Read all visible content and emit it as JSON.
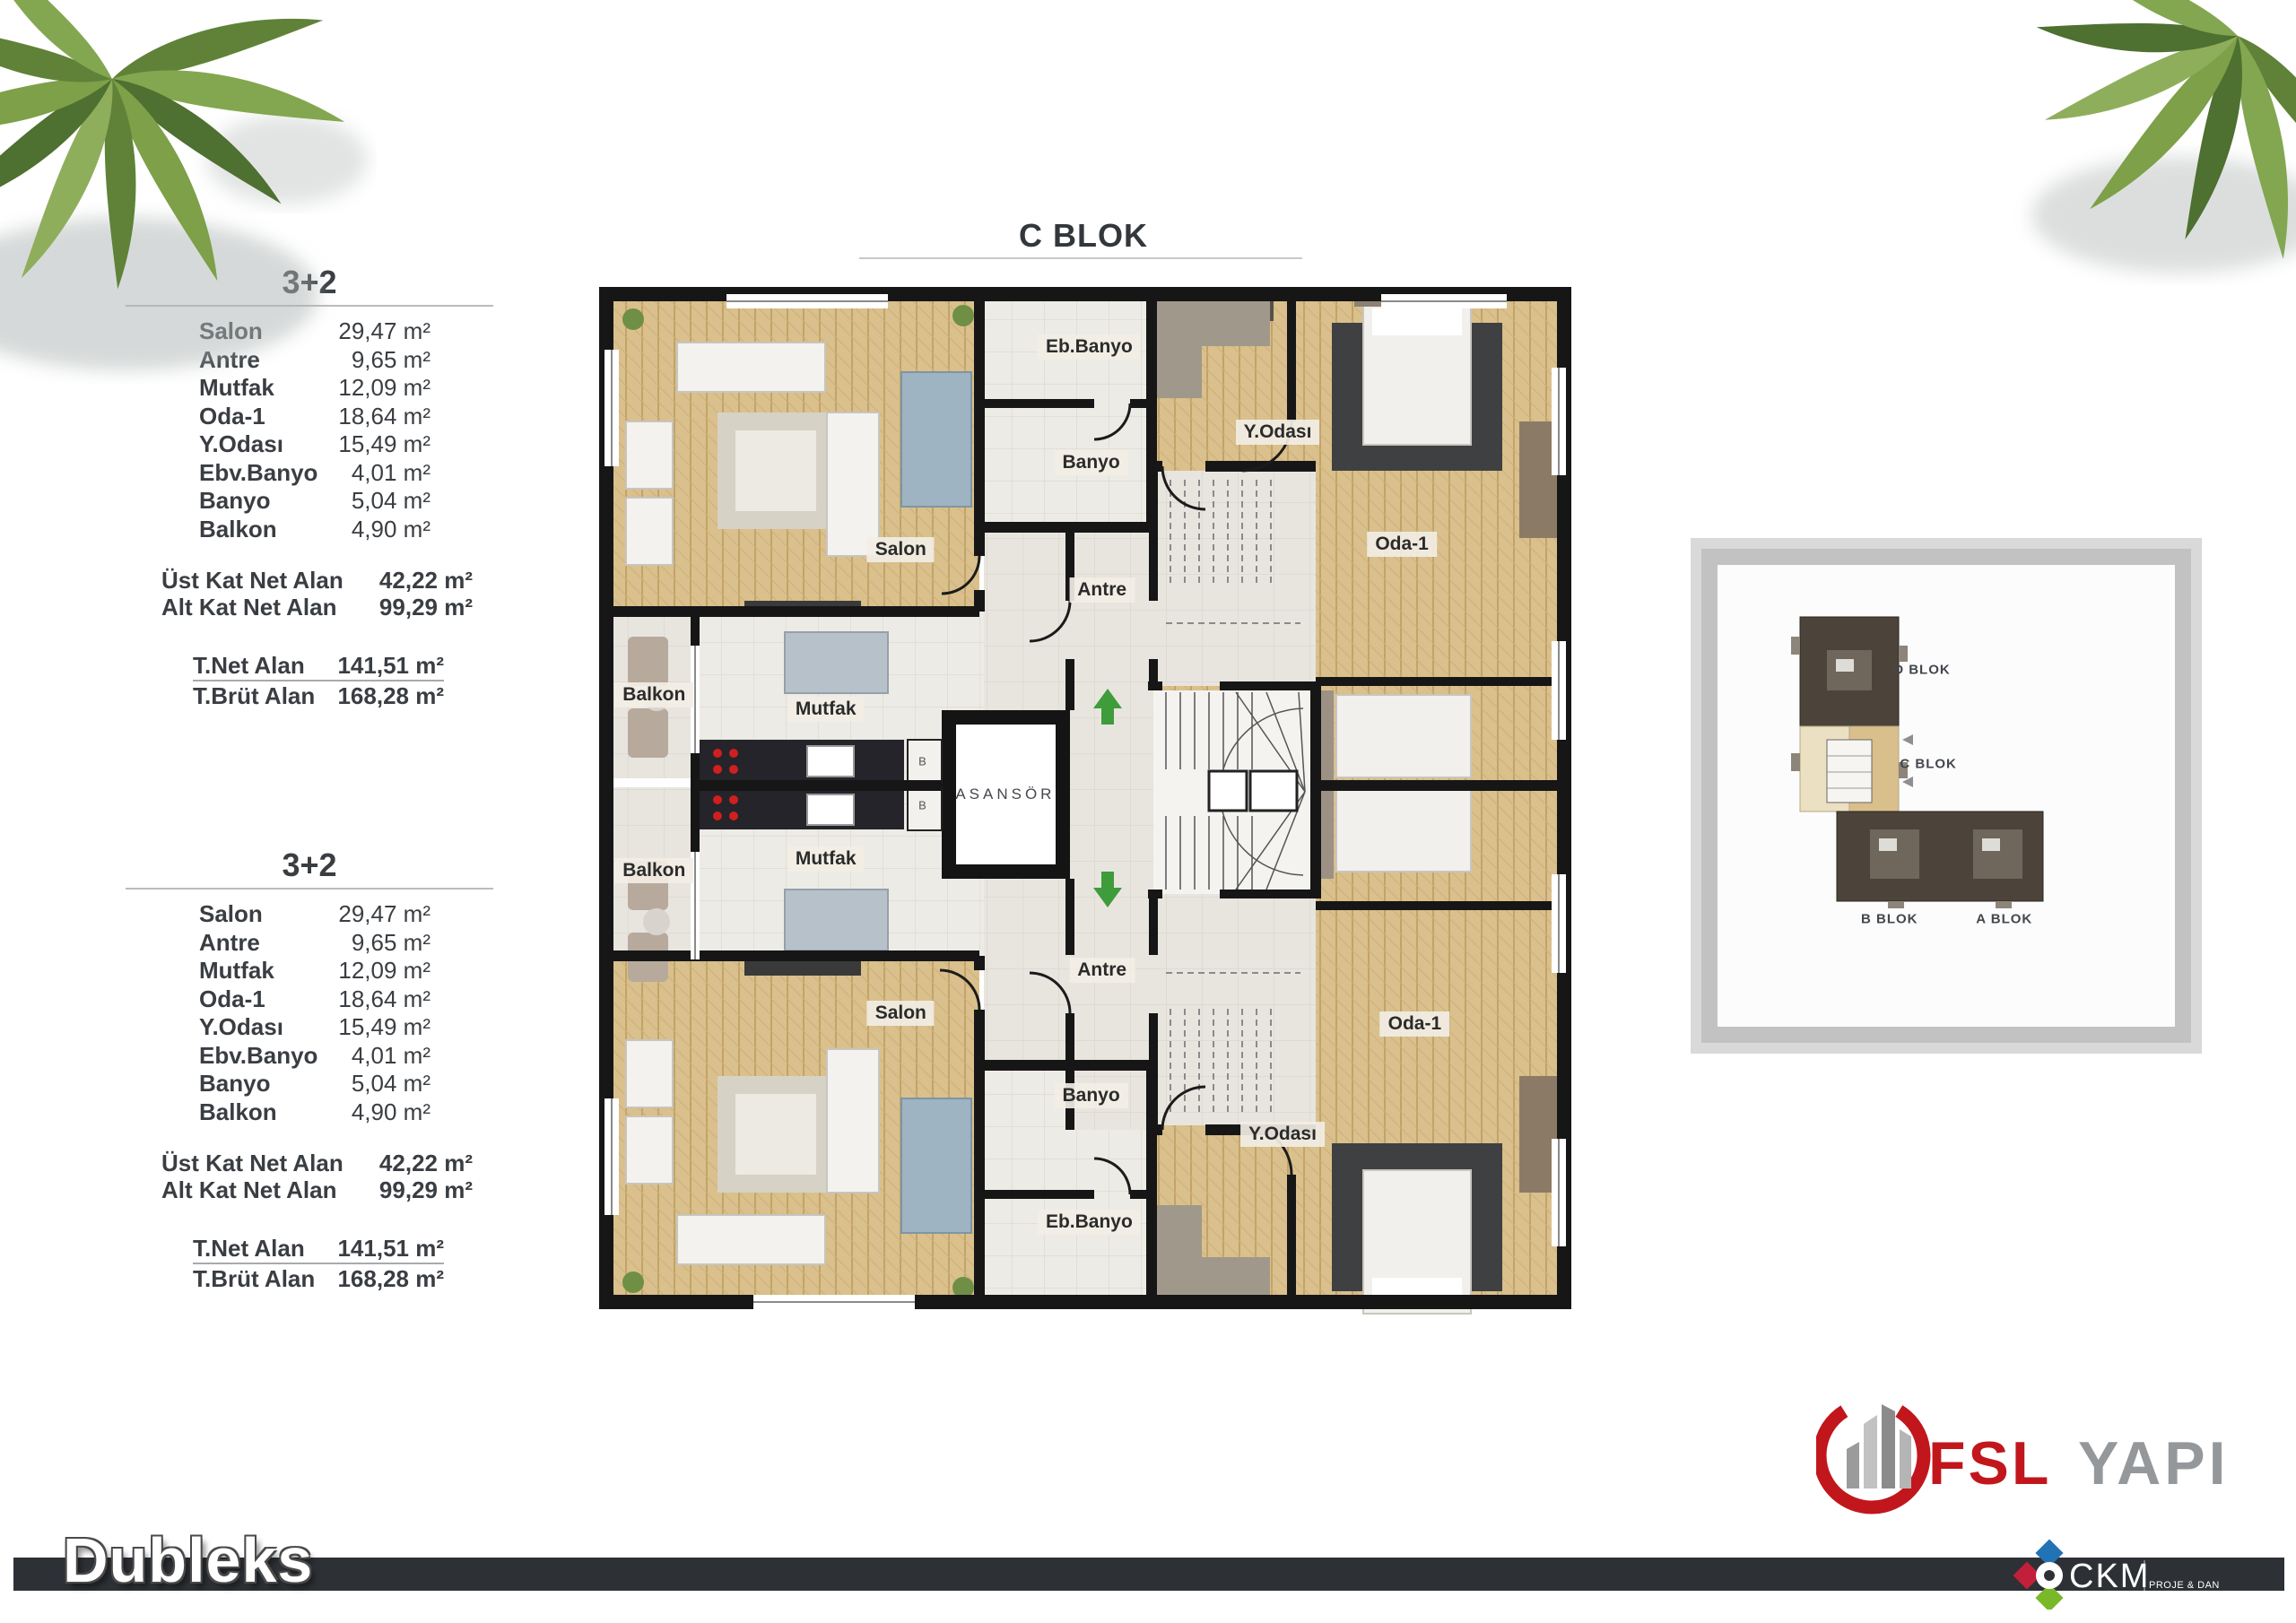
{
  "title": {
    "text": "C BLOK"
  },
  "unit_tables": [
    {
      "title": "3+2",
      "rooms": [
        {
          "label": "Salon",
          "area": "29,47 m²"
        },
        {
          "label": "Antre",
          "area": "9,65 m²"
        },
        {
          "label": "Mutfak",
          "area": "12,09 m²"
        },
        {
          "label": "Oda-1",
          "area": "18,64 m²"
        },
        {
          "label": "Y.Odası",
          "area": "15,49 m²"
        },
        {
          "label": "Ebv.Banyo",
          "area": "4,01 m²"
        },
        {
          "label": "Banyo",
          "area": "5,04 m²"
        },
        {
          "label": "Balkon",
          "area": "4,90 m²"
        }
      ],
      "subtotals": [
        {
          "label": "Üst Kat Net Alan",
          "area": "42,22 m²"
        },
        {
          "label": "Alt Kat Net Alan",
          "area": "99,29 m²"
        }
      ],
      "totals": [
        {
          "label": "T.Net Alan",
          "area": "141,51 m²"
        },
        {
          "label": "T.Brüt Alan",
          "area": "168,28 m²"
        }
      ]
    },
    {
      "title": "3+2",
      "rooms": [
        {
          "label": "Salon",
          "area": "29,47 m²"
        },
        {
          "label": "Antre",
          "area": "9,65 m²"
        },
        {
          "label": "Mutfak",
          "area": "12,09 m²"
        },
        {
          "label": "Oda-1",
          "area": "18,64 m²"
        },
        {
          "label": "Y.Odası",
          "area": "15,49 m²"
        },
        {
          "label": "Ebv.Banyo",
          "area": "4,01 m²"
        },
        {
          "label": "Banyo",
          "area": "5,04 m²"
        },
        {
          "label": "Balkon",
          "area": "4,90 m²"
        }
      ],
      "subtotals": [
        {
          "label": "Üst Kat Net Alan",
          "area": "42,22 m²"
        },
        {
          "label": "Alt Kat Net Alan",
          "area": "99,29 m²"
        }
      ],
      "totals": [
        {
          "label": "T.Net Alan",
          "area": "141,51 m²"
        },
        {
          "label": "T.Brüt Alan",
          "area": "168,28 m²"
        }
      ]
    }
  ],
  "floor_plan": {
    "room_labels": [
      {
        "id": "eb-banyo-upper",
        "text": "Eb.Banyo",
        "x": 50.4,
        "y": 5.8
      },
      {
        "id": "banyo-upper",
        "text": "Banyo",
        "x": 50.6,
        "y": 16.9
      },
      {
        "id": "salon-upper",
        "text": "Salon",
        "x": 31.3,
        "y": 25.3
      },
      {
        "id": "antre-upper",
        "text": "Antre",
        "x": 51.7,
        "y": 29.1
      },
      {
        "id": "y-odasi-upper",
        "text": "Y.Odası",
        "x": 69.5,
        "y": 14.0
      },
      {
        "id": "oda-1-upper",
        "text": "Oda-1",
        "x": 82.1,
        "y": 24.7
      },
      {
        "id": "balkon-upper",
        "text": "Balkon",
        "x": 6.3,
        "y": 39.2
      },
      {
        "id": "mutfak-upper",
        "text": "Mutfak",
        "x": 23.7,
        "y": 40.6
      },
      {
        "id": "dolap-b-upper",
        "text": "B",
        "x": 33.5,
        "y": 45.6,
        "style": "tiny"
      },
      {
        "id": "asansor",
        "text": "ASANSÖR",
        "x": 41.9,
        "y": 48.8,
        "style": "elevator"
      },
      {
        "id": "dolap-b-lower",
        "text": "B",
        "x": 33.5,
        "y": 49.8,
        "style": "tiny"
      },
      {
        "id": "balkon-lower",
        "text": "Balkon",
        "x": 6.3,
        "y": 56.1
      },
      {
        "id": "mutfak-lower",
        "text": "Mutfak",
        "x": 23.7,
        "y": 55.0
      },
      {
        "id": "antre-lower",
        "text": "Antre",
        "x": 51.7,
        "y": 65.7
      },
      {
        "id": "salon-lower",
        "text": "Salon",
        "x": 31.3,
        "y": 69.8
      },
      {
        "id": "banyo-lower",
        "text": "Banyo",
        "x": 50.6,
        "y": 77.8
      },
      {
        "id": "y-odasi-lower",
        "text": "Y.Odası",
        "x": 70.0,
        "y": 81.5
      },
      {
        "id": "oda-1-lower",
        "text": "Oda-1",
        "x": 83.4,
        "y": 70.9
      },
      {
        "id": "eb-banyo-lower",
        "text": "Eb.Banyo",
        "x": 50.4,
        "y": 89.9
      }
    ],
    "icons": {
      "stairs_up": "green-up-arrow",
      "stairs_down": "green-down-arrow"
    }
  },
  "site_plan": {
    "block_labels": [
      {
        "id": "d-blok",
        "text": "D BLOK",
        "x": 44.7,
        "y": 22.7
      },
      {
        "id": "c-blok",
        "text": "C BLOK",
        "x": 46.1,
        "y": 43.1
      },
      {
        "id": "b-blok",
        "text": "B BLOK",
        "x": 37.6,
        "y": 76.7
      },
      {
        "id": "a-blok",
        "text": "A BLOK",
        "x": 62.7,
        "y": 76.7
      }
    ]
  },
  "footer": {
    "plan_type": "Dubleks"
  },
  "brand": {
    "primary": "FSL",
    "secondary": "YAPI"
  },
  "consultant": {
    "name": "CKM",
    "subtitle": "PROJE & DANIŞMANLIK"
  },
  "decor": {
    "palm_left": "palm-tree",
    "palm_right": "palm-tree"
  },
  "colors": {
    "text": "#3a3e43",
    "wall": "#161616",
    "wood": "#d9c08c",
    "tile": "#edebe5",
    "hall": "#e8e5df",
    "bar": "#2d3136",
    "brand_red": "#c2161d",
    "brand_gray": "#95989b",
    "ckm_blue": "#2273b5",
    "ckm_red": "#c2203a",
    "ckm_green": "#79b829",
    "arrow_green": "#3e9c3a"
  }
}
